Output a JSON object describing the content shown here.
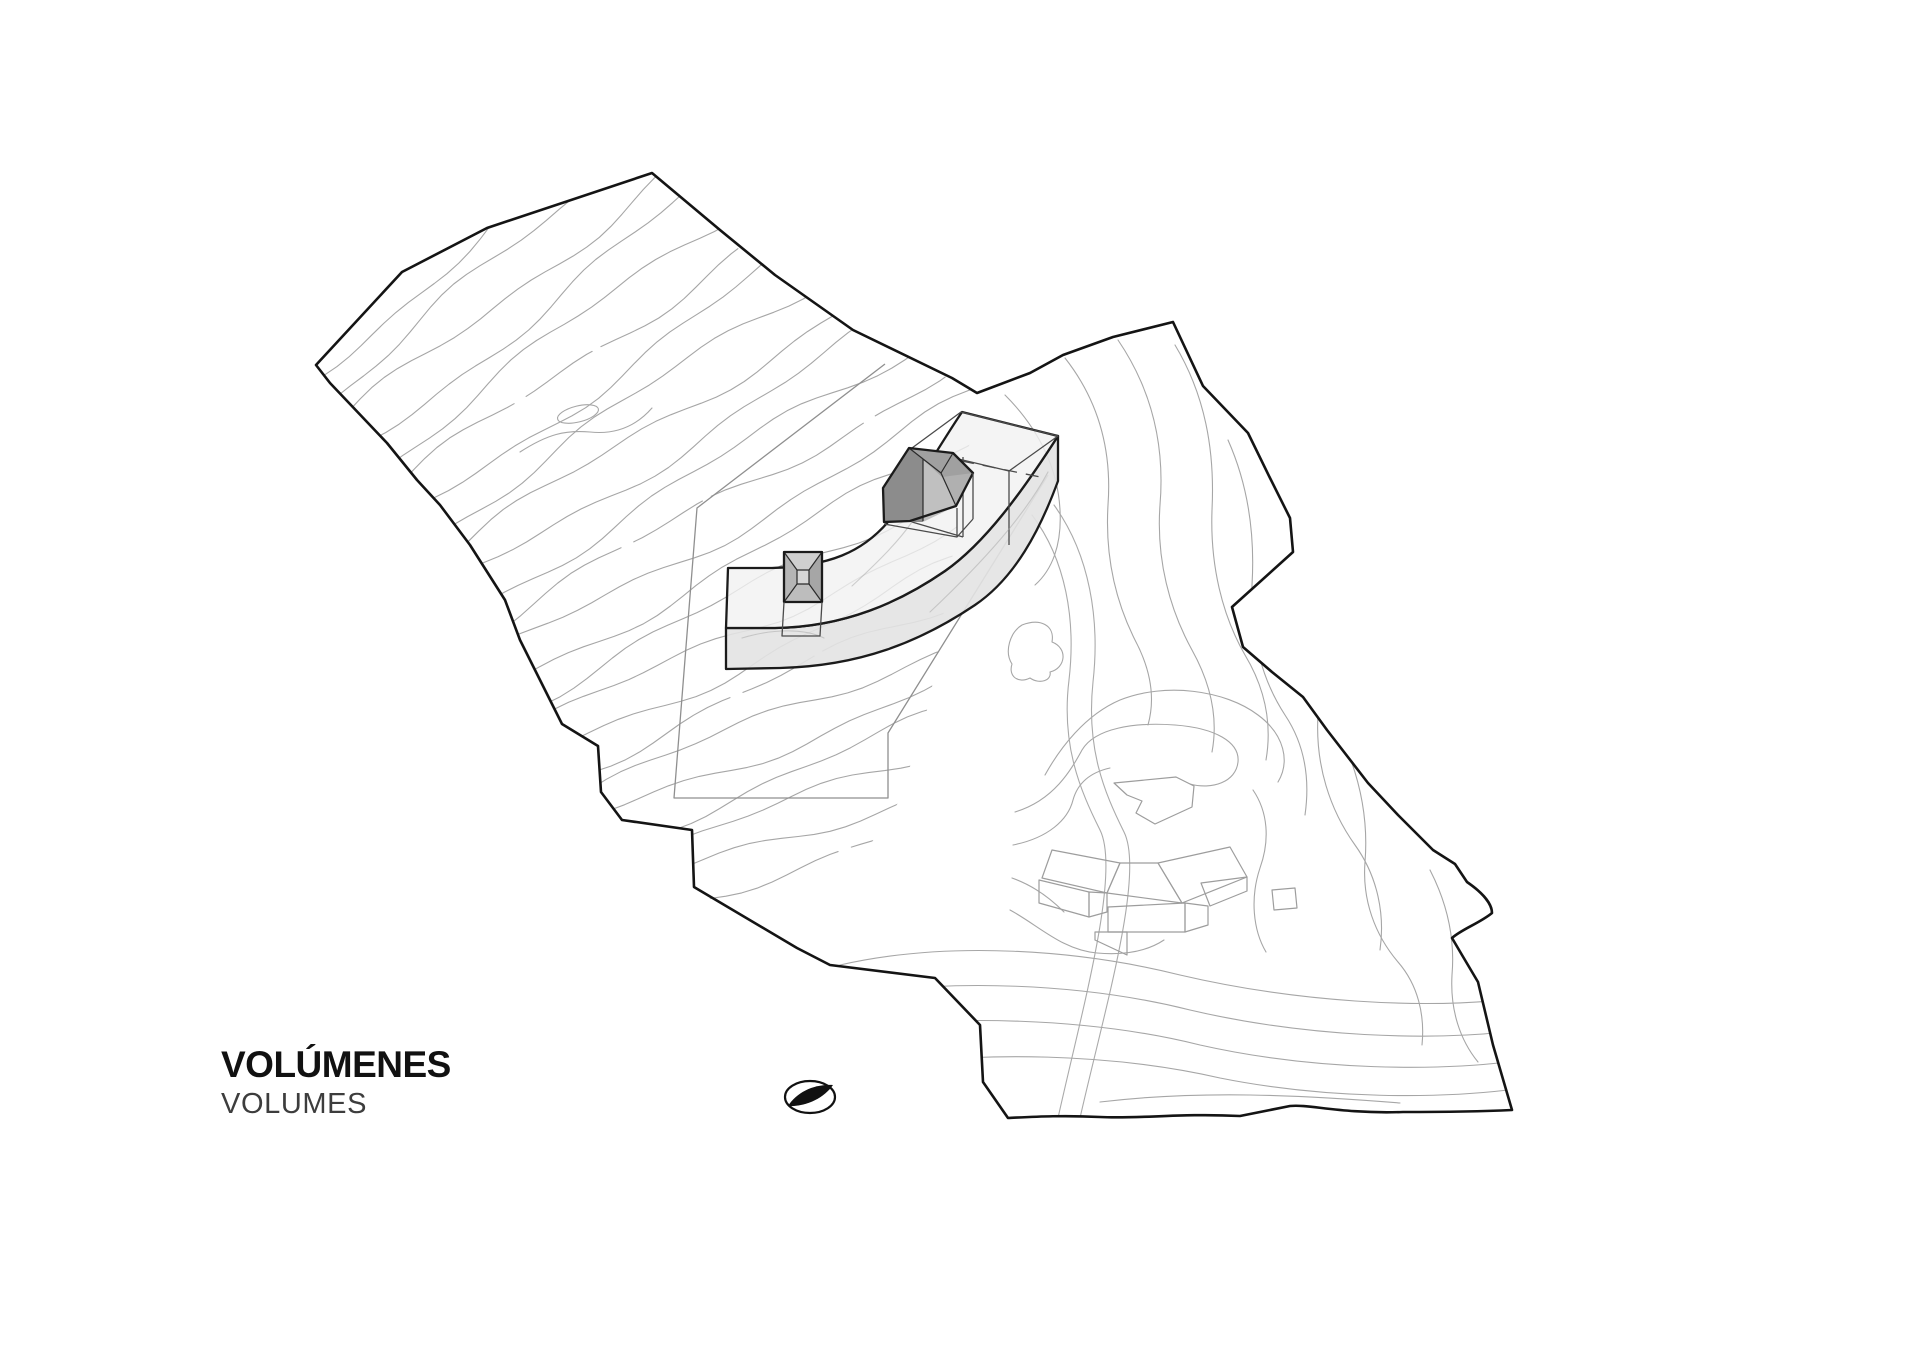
{
  "title_block": {
    "title": "VOLÚMENES",
    "subtitle": "VOLUMES",
    "title_color": "#111111",
    "subtitle_color": "#3d3d3d"
  },
  "drawing": {
    "type": "architectural-site-plan-axonometric",
    "description": "Topographic site plan with contour lines, site boundary, existing buildings and proposed curved building volume with two roof volumes",
    "colors": {
      "background": "#ffffff",
      "site_boundary": "#141414",
      "contour": "#a6a6a6",
      "subparcel_line": "#8f8f8f",
      "existing_buildings": "#9d9d9d",
      "slab_top": "#f1f1f1",
      "slab_side": "#e3e3e3",
      "volume_outline": "#1b1b1b",
      "house_dark_face": "#8c8c8c",
      "house_roof": "#a0a0a0",
      "house_light_face": "#c0c0c0",
      "small_box_fill": "#c4c4c4",
      "north_arrow_ink": "#111111"
    },
    "north_arrow": {
      "icon": "ellipse-with-black-leaf",
      "points": "north-east"
    },
    "contours_left": {
      "count": 24,
      "angle_start": 40,
      "angle_end": 18,
      "amp1": 8,
      "wave1": 78,
      "amp2": 3.5,
      "wave2": 27,
      "step": 16,
      "length": 680,
      "start_x": 318,
      "start_y": 372,
      "end_x": 706,
      "end_y": 893,
      "dash_every": 6,
      "dash_pattern": "170 14 80 10"
    }
  }
}
